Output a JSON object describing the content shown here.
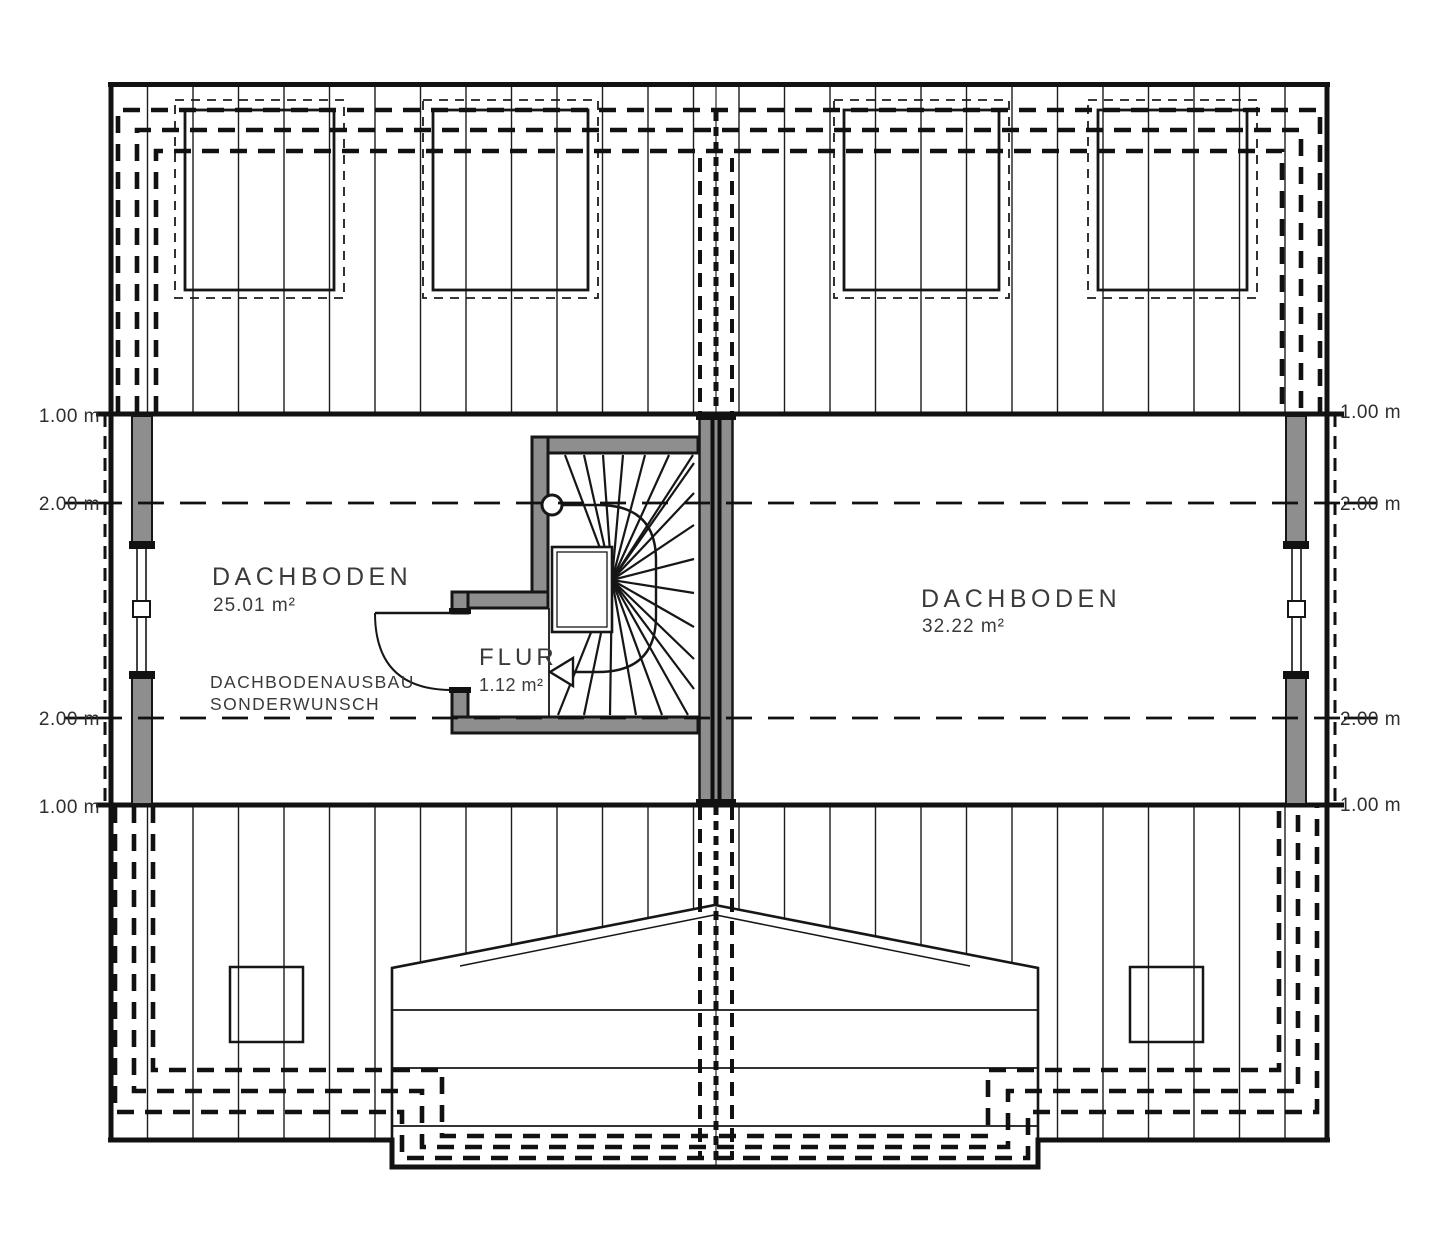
{
  "plan": {
    "rooms": {
      "left": {
        "name": "DACHBODEN",
        "area": "25.01 m²"
      },
      "right": {
        "name": "DACHBODEN",
        "area": "32.22 m²"
      },
      "hall": {
        "name": "FLUR",
        "area": "1.12 m²"
      }
    },
    "annotation": {
      "line1": "DACHBODENAUSBAU",
      "line2": "SONDERWUNSCH"
    },
    "dimensions": {
      "left": [
        "1.00 m",
        "2.00 m",
        "2.00 m",
        "1.00 m"
      ],
      "right": [
        "1.00 m",
        "2.00 m",
        "2.00 m",
        "1.00 m"
      ]
    },
    "colors": {
      "line": "#161616",
      "wall_fill": "#8e8e8e",
      "label_text": "#3a3a3a",
      "background": "#ffffff"
    }
  }
}
